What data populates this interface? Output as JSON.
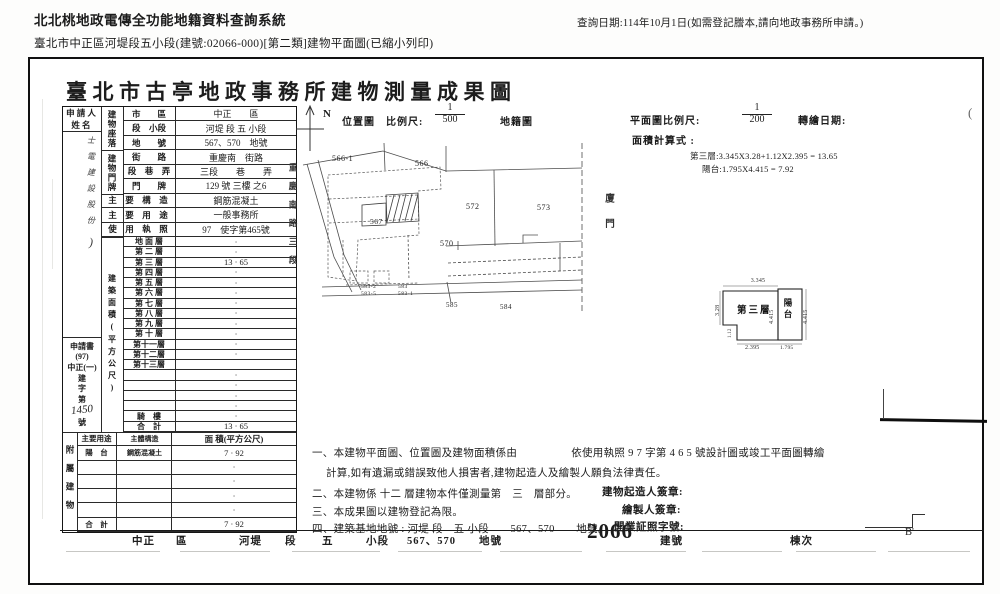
{
  "header": {
    "system_title": "北北桃地政電傳全功能地籍資料查詢系統",
    "query_date": "查詢日期:114年10月1日(如需登記謄本,請向地政事務所申請。)",
    "doc_subtitle": "臺北市中正區河堤段五小段(建號:02066-000)[第二類]建物平面圖(已縮小列印)"
  },
  "sheet": {
    "title": "臺北市古亭地政事務所建物測量成果圖",
    "applicant": {
      "label_line1": "申 請 人",
      "label_line2": "姓   名",
      "handwriting": "士電建設股份",
      "handwriting_mark": ")",
      "application_stack": [
        "申請書",
        "(97)",
        "中正(一)",
        "建",
        "字",
        "第"
      ],
      "application_no": "1450",
      "application_no_suffix": "號"
    },
    "table": {
      "location_group": "建物座落",
      "address_group": "建物門牌",
      "fields": [
        {
          "label": "市　　區",
          "value": "中正　　區"
        },
        {
          "label": "段　小段",
          "value": "河堤 段 五 小段"
        },
        {
          "label": "地　　號",
          "value": "567、570　地號"
        },
        {
          "label": "街　　路",
          "value": "重慶南　街路"
        },
        {
          "label": "段　巷　弄",
          "value": "三段　　巷　　弄"
        },
        {
          "label": "門　　牌",
          "value": "129 號 三樓 之6"
        },
        {
          "label": "主　要　構　造",
          "value": "鋼筋混凝土"
        },
        {
          "label": "主　要　用　途",
          "value": "一般事務所"
        },
        {
          "label": "使　用　執　照",
          "value": "97　使字第465號"
        }
      ],
      "floor_area_group": "建築面積(平方公尺)",
      "floors": [
        {
          "label": "地 面 層",
          "value": "·"
        },
        {
          "label": "第 二 層",
          "value": "·"
        },
        {
          "label": "第 三 層",
          "value": "13 · 65"
        },
        {
          "label": "第 四 層",
          "value": "·"
        },
        {
          "label": "第 五 層",
          "value": "·"
        },
        {
          "label": "第 六 層",
          "value": "·"
        },
        {
          "label": "第 七 層",
          "value": "·"
        },
        {
          "label": "第 八 層",
          "value": "·"
        },
        {
          "label": "第 九 層",
          "value": "·"
        },
        {
          "label": "第 十 層",
          "value": "·"
        },
        {
          "label": "第十一層",
          "value": "·"
        },
        {
          "label": "第十二層",
          "value": "·"
        },
        {
          "label": "第十三層",
          "value": ""
        },
        {
          "label": "",
          "value": "·"
        },
        {
          "label": "",
          "value": "·"
        },
        {
          "label": "",
          "value": "·"
        },
        {
          "label": "",
          "value": "·"
        },
        {
          "label": "騎　樓",
          "value": "·"
        },
        {
          "label": "合　計",
          "value": "13 · 65"
        }
      ],
      "attached_group": "附屬建物",
      "attached_header": {
        "use": "主要用途",
        "structure": "主體構造",
        "area": "面 積(平方公尺)"
      },
      "attached_rows": [
        {
          "use": "陽　台",
          "structure": "鋼筋混凝土",
          "area": "7 · 92"
        },
        {
          "use": "",
          "structure": "",
          "area": "·"
        },
        {
          "use": "",
          "structure": "",
          "area": "·"
        },
        {
          "use": "",
          "structure": "",
          "area": "·"
        },
        {
          "use": "",
          "structure": "",
          "area": "·"
        },
        {
          "use": "合　計",
          "structure": "",
          "area": "7 · 92"
        }
      ]
    },
    "location_map": {
      "north": "N",
      "caption": "位置圖　比例尺:",
      "scale_top": "1",
      "scale_bottom": "500",
      "caption_right": "地籍圖",
      "street_left": "重慶南路三段",
      "street_right": "廈門",
      "parcels": [
        "566-1",
        "566",
        "567",
        "570",
        "572",
        "573",
        "583-2",
        "583-5",
        "583",
        "583-1",
        "585",
        "584"
      ]
    },
    "plan_header": {
      "scale_label": "平面圖比例尺:",
      "scale_top": "1",
      "scale_bottom": "200",
      "date_label": "轉繪日期:",
      "calc_label": "面積計算式 :",
      "calc_lines": [
        "第三層:3.345X3.28+1.12X2.395 = 13.65",
        "陽台:1.795X4.415 = 7.92"
      ]
    },
    "floor_plan": {
      "room": "第三層",
      "balcony": "陽台",
      "dim_top": "3.345",
      "dim_left": "3.28",
      "dim_notch": "1.12",
      "dim_bottom": "2.395",
      "dim_room_right": "4.415",
      "dim_balcony_right": "4.415",
      "dim_balcony_bottom": "1.795"
    },
    "notes": {
      "line1": "一、本建物平面圖、位置圖及建物面積係由　　　　　依使用執照 9 7 字第 4 6 5 號設計圖或竣工平面圖轉繪",
      "line1b": "計算,如有遺漏或錯誤致他人損害者,建物起造人及繪製人願負法律責任。",
      "line2": "二、本建物係 十二 層建物本件僅測量第　三　層部分。",
      "line3": "三、本成果圖以建物登記為限。",
      "line4": "四、建築基地地號 : 河堤 段　五 小段　　567、570　　地號。",
      "sign_builder": "建物起造人簽章:",
      "sign_drafter": "繪製人簽章:",
      "sign_license": "開業証照字號:"
    },
    "bottom": {
      "items": [
        "中正",
        "區",
        "河堤",
        "段",
        "五",
        "小段",
        "567、570",
        "地號",
        "2066",
        "建號",
        "棟次"
      ],
      "mark": "B'",
      "corner_mark": "("
    }
  }
}
